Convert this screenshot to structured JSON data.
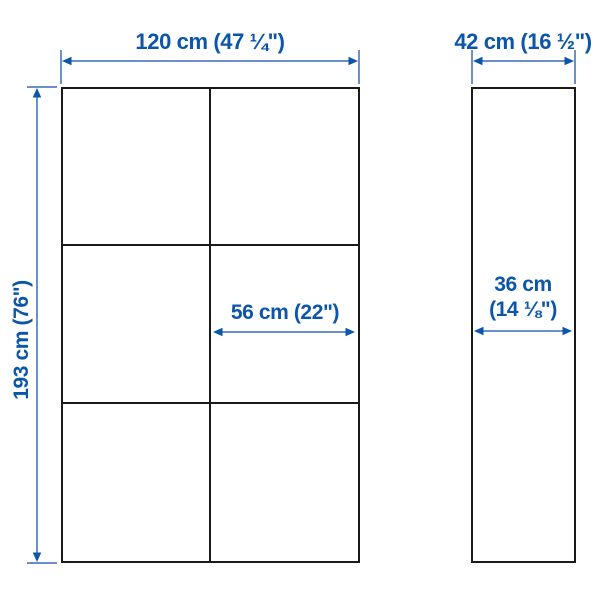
{
  "colors": {
    "background": "#ffffff",
    "dimension_text_blue": "#0b55ab",
    "dimension_line_blue": "#3a6ab8",
    "outline_black": "#1a1a1a"
  },
  "dimensions": {
    "total_width": {
      "label": "120 cm (47 ¼\")"
    },
    "total_depth": {
      "label": "42 cm (16 ½\")"
    },
    "total_height": {
      "label": "193 cm (76\")"
    },
    "section_width": {
      "label": "56 cm (22\")"
    },
    "interior_depth": {
      "line1": "36 cm",
      "line2": "(14 ⅛\")"
    }
  }
}
